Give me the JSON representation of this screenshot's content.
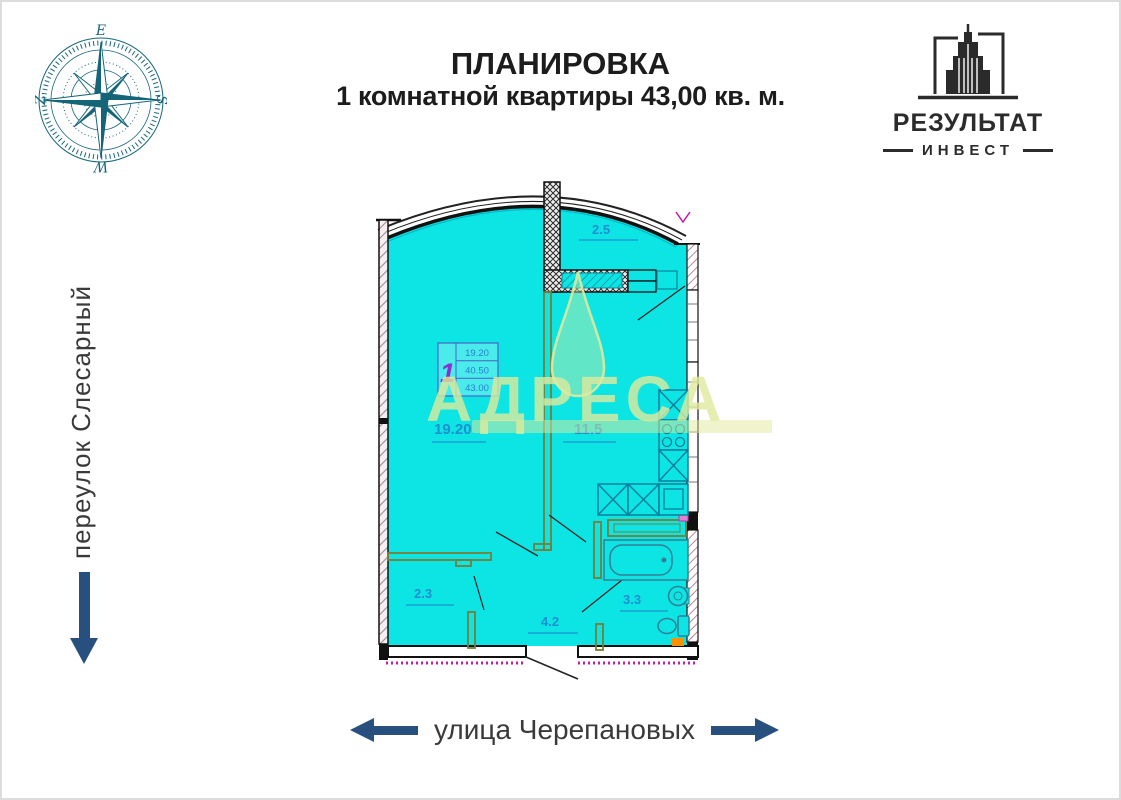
{
  "header": {
    "line1": "ПЛАНИРОВКА",
    "line2": "1 комнатной квартиры 43,00 кв. м."
  },
  "logo": {
    "title": "РЕЗУЛЬТАТ",
    "subtitle": "ИНВЕСТ"
  },
  "compass": {
    "top": "E",
    "right": "S",
    "bottom": "W",
    "left": "Z"
  },
  "streets": {
    "left": "переулок Слесарный",
    "bottom": "улица Черепановых"
  },
  "plan": {
    "watermark": "АДРЕСА",
    "stamp": {
      "rooms": "1",
      "row1": "19.20",
      "row2": "40.50",
      "row3": "43.00"
    },
    "labels": {
      "balcony": "2.5",
      "living": "19.20",
      "kitchen": "11.5",
      "closet": "2.3",
      "hall": "4.2",
      "bath": "3.3"
    }
  },
  "colors": {
    "cyan": "#0de4e4",
    "wall_black": "#111111",
    "partition_olive": "#7d7b33",
    "fixture_teal": "#0a7f9b",
    "label_blue": "#1f8fd2",
    "stamp_purple": "#8a2fd2",
    "arrow_navy": "#27507f",
    "magenta": "#bf1fa4",
    "orange": "#f79300",
    "watermark_pale": "#e2ea9e",
    "compass_teal": "#156579"
  }
}
